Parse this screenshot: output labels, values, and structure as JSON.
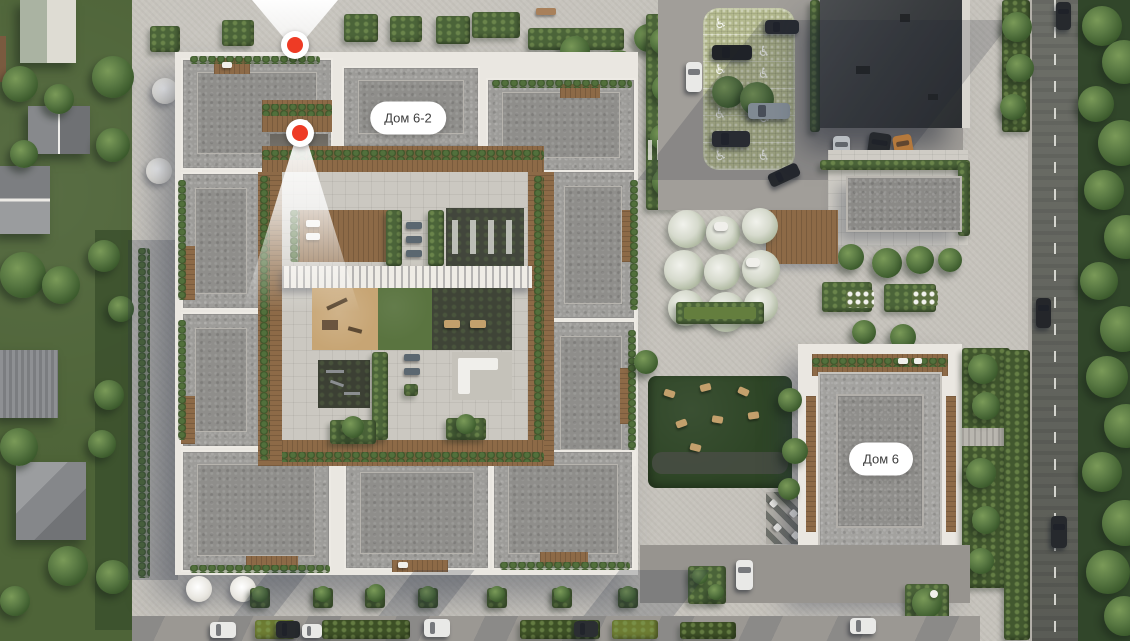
{
  "scene": {
    "type": "residential-complex-masterplan-aerial-view",
    "labels": {
      "house_6_2": "Дом 6-2",
      "house_6": "Дом 6"
    },
    "markers": [
      {
        "id": "camera-marker-north",
        "beam_direction": "up"
      },
      {
        "id": "camera-marker-courtyard",
        "beam_direction": "down"
      }
    ],
    "icons": {
      "accessible_parking": "♿"
    },
    "palette": {
      "marker_red": "#ee3b25",
      "label_bg": "#ffffff",
      "label_text": "#3d3d3d",
      "roof_gravel": "#9d9c99",
      "parapet_white": "#eae7e1",
      "wood_deck": "#8d6a47",
      "lawn_green": "#55703c",
      "pavement": "#c6c3bc",
      "road_asphalt": "#64665f"
    }
  }
}
